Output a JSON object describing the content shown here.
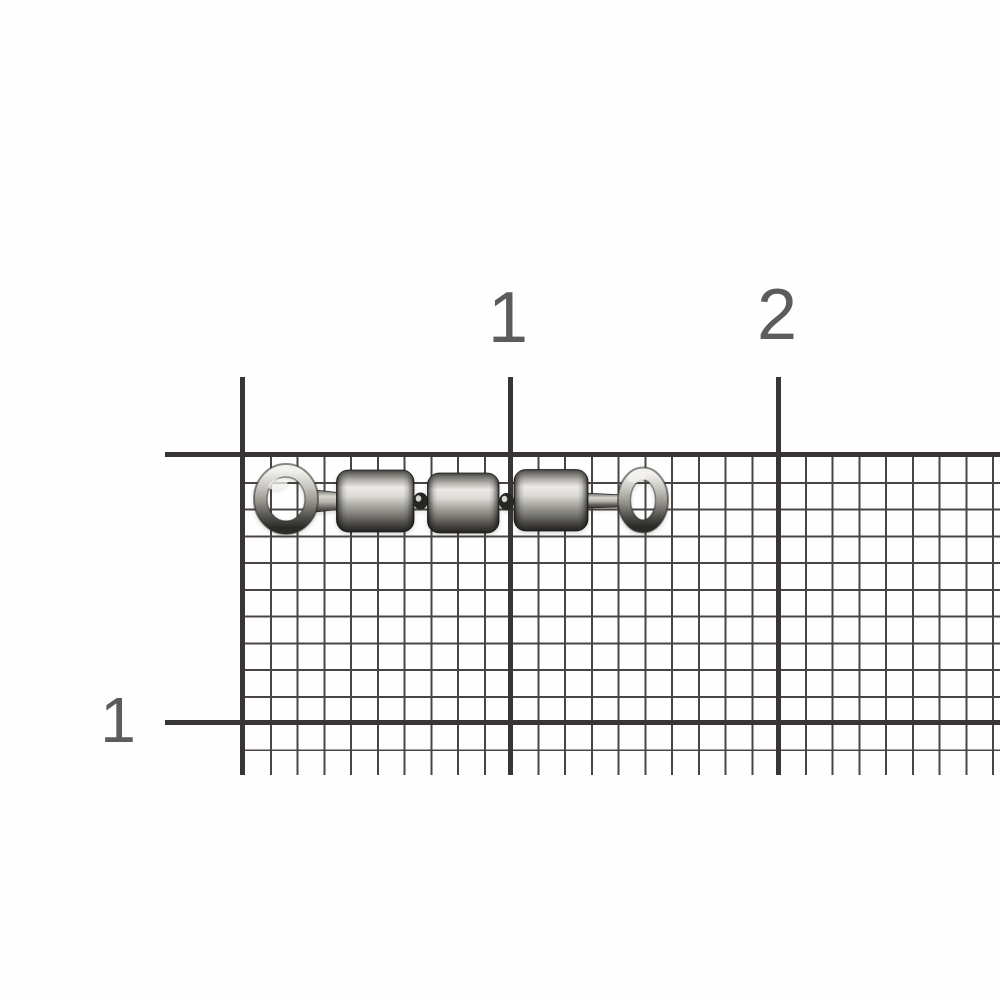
{
  "scene": {
    "background_color": "#fefefe",
    "description": "Product photo of a stainless triple-barrel fishing swivel with eye rings at both ends, lying horizontally on millimeter graph paper with centimeter ruler markings"
  },
  "ruler": {
    "top_labels": [
      {
        "text": "1",
        "approx_x_px": 508
      },
      {
        "text": "2",
        "approx_x_px": 777
      }
    ],
    "left_labels": [
      {
        "text": "1",
        "approx_y_px": 720
      }
    ],
    "label_color": "#5c5c5e",
    "unit": "cm"
  },
  "grid": {
    "minor_color": "#4a4545",
    "major_color": "#393535",
    "minor_spacing_px": 26.75,
    "cells_per_major": 10
  },
  "object": {
    "name": "triple-barrel-swivel",
    "parts": [
      "left eye ring",
      "barrel 1",
      "swivel pin 1",
      "barrel 2",
      "swivel pin 2",
      "barrel 3",
      "right eye ring"
    ],
    "material_colors": {
      "highlight": "#eceae6",
      "mid": "#a9a7a1",
      "dark": "#2c2b28"
    }
  }
}
